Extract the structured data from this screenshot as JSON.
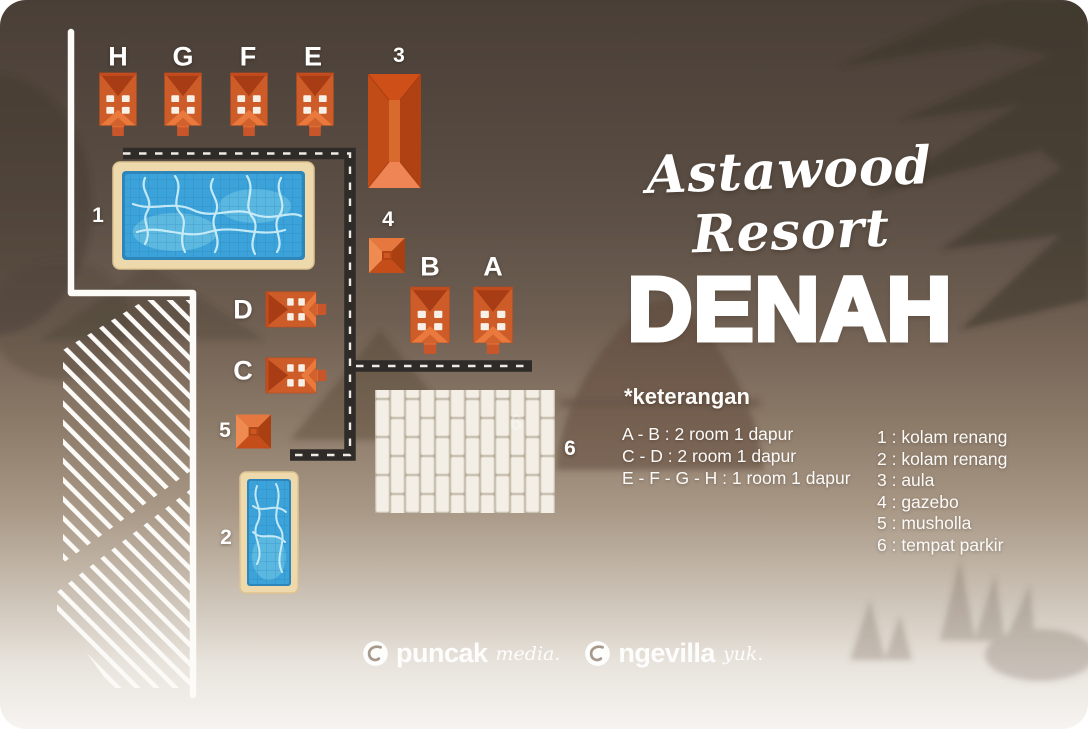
{
  "title": {
    "script": "Astawood Resort",
    "main": "DENAH"
  },
  "legend": {
    "heading": "*keterangan",
    "room_notes": [
      "A - B : 2 room 1 dapur",
      "C - D : 2 room 1 dapur",
      "E - F - G - H : 1 room 1 dapur"
    ],
    "numbered_items": [
      "1 : kolam renang",
      "2 : kolam renang",
      "3 : aula",
      "4 : gazebo",
      "5 : musholla",
      "6 : tempat parkir"
    ]
  },
  "map": {
    "labels": [
      "H",
      "G",
      "F",
      "E",
      "3",
      "1",
      "4",
      "B",
      "A",
      "D",
      "C",
      "5",
      "2",
      "6"
    ],
    "parking_watermark": "6"
  },
  "footer": {
    "brand1_name": "puncak",
    "brand1_suffix": "media.",
    "brand2_name": "ngevilla",
    "brand2_suffix": "yuk."
  },
  "colors": {
    "cabin_orange": "#cd5c28",
    "cabin_roof_dark": "#a83d15",
    "pool_water": "#3ba3d9",
    "pool_deck": "#eed9ad",
    "road_dark": "#2e2b28",
    "line_white": "#fcfbf8"
  }
}
